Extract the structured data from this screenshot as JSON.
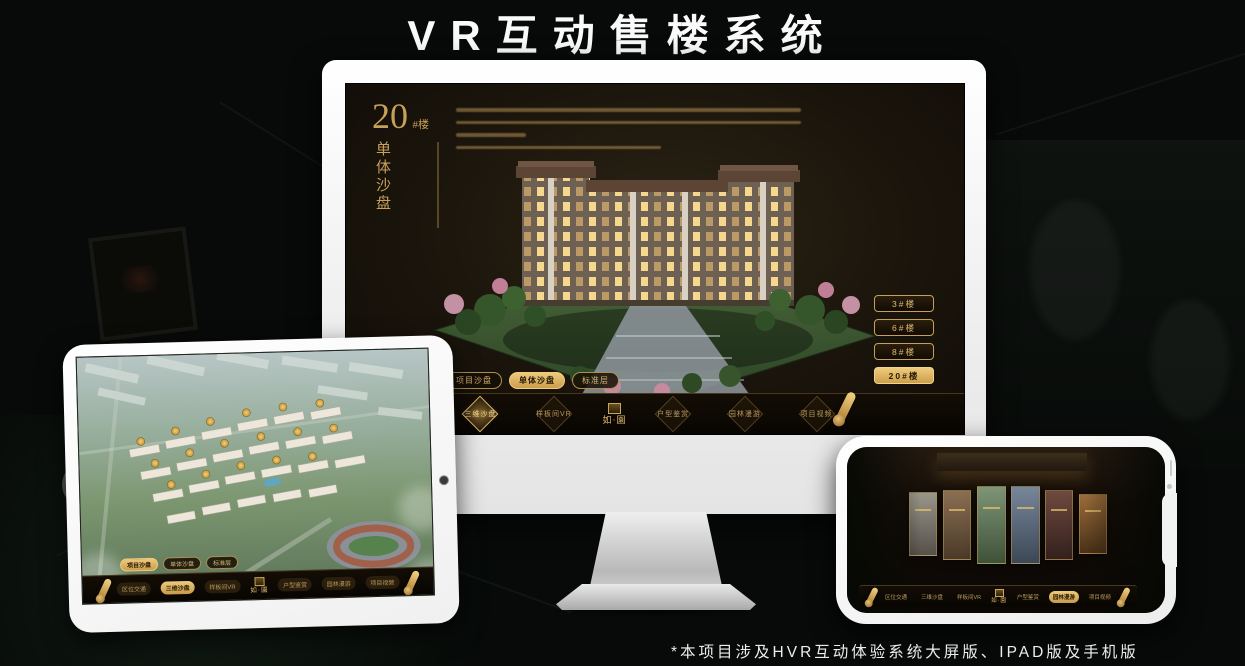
{
  "page": {
    "title": "VR互动售楼系统",
    "footnote": "*本项目涉及HVR互动体验系统大屏版、IPAD版及手机版"
  },
  "colors": {
    "gold": "#d2ab63",
    "gold_bright": "#ecca7c",
    "screen_dark": "#1d170d",
    "monitor_white": "#f2f2f2"
  },
  "logo": {
    "name": "如·園"
  },
  "nav_items": [
    "区位交通",
    "三维沙盘",
    "样板间VR",
    "户型鉴赏",
    "园林漫游",
    "项目视频"
  ],
  "monitor": {
    "building_label": {
      "number": "20",
      "suffix": "#楼",
      "subtitle": "单体沙盘"
    },
    "floor_buttons": [
      {
        "label": "3#楼",
        "active": false
      },
      {
        "label": "6#楼",
        "active": false
      },
      {
        "label": "8#楼",
        "active": false
      },
      {
        "label": "20#楼",
        "active": true
      }
    ],
    "mode_tabs": [
      {
        "label": "项目沙盘",
        "active": false
      },
      {
        "label": "单体沙盘",
        "active": true
      },
      {
        "label": "标准层",
        "active": false
      }
    ],
    "active_nav": "三维沙盘"
  },
  "tablet": {
    "mode_tabs": [
      {
        "label": "项目沙盘",
        "active": true
      },
      {
        "label": "单体沙盘",
        "active": false
      },
      {
        "label": "标准层",
        "active": false
      }
    ],
    "active_nav": "三维沙盘"
  },
  "phone": {
    "active_nav": "园林漫游"
  }
}
